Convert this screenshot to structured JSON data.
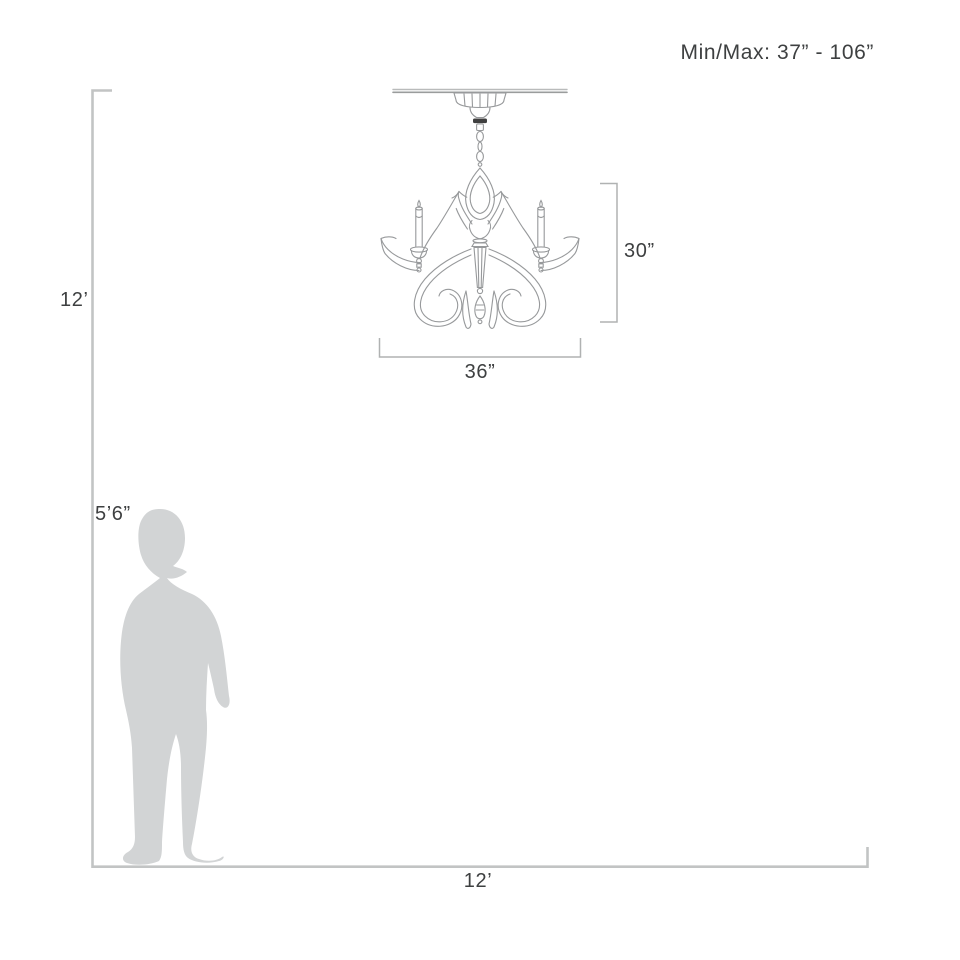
{
  "diagram": {
    "title": "Chandelier mounting dimensions diagram",
    "min_max_label": "Min/Max: 37” - 106”",
    "room_height_label": "12’",
    "room_width_label": "12’",
    "person_height_label": "5’6”",
    "fixture_height_label": "30”",
    "fixture_width_label": "36”"
  },
  "dimensions": {
    "room_height_ft": 12,
    "room_width_ft": 12,
    "person_height": "5 ft 6 in",
    "fixture_height_in": 30,
    "fixture_width_in": 36,
    "hanging_min_in": 37,
    "hanging_max_in": 106
  },
  "colors": {
    "background": "#ffffff",
    "room_line": "#c2c4c4",
    "bracket_line": "#b0b2b2",
    "fixture_line": "#97999b",
    "fixture_dark_accent": "#3f3f3f",
    "silhouette": "#d2d4d5",
    "text": "#3e4041"
  }
}
